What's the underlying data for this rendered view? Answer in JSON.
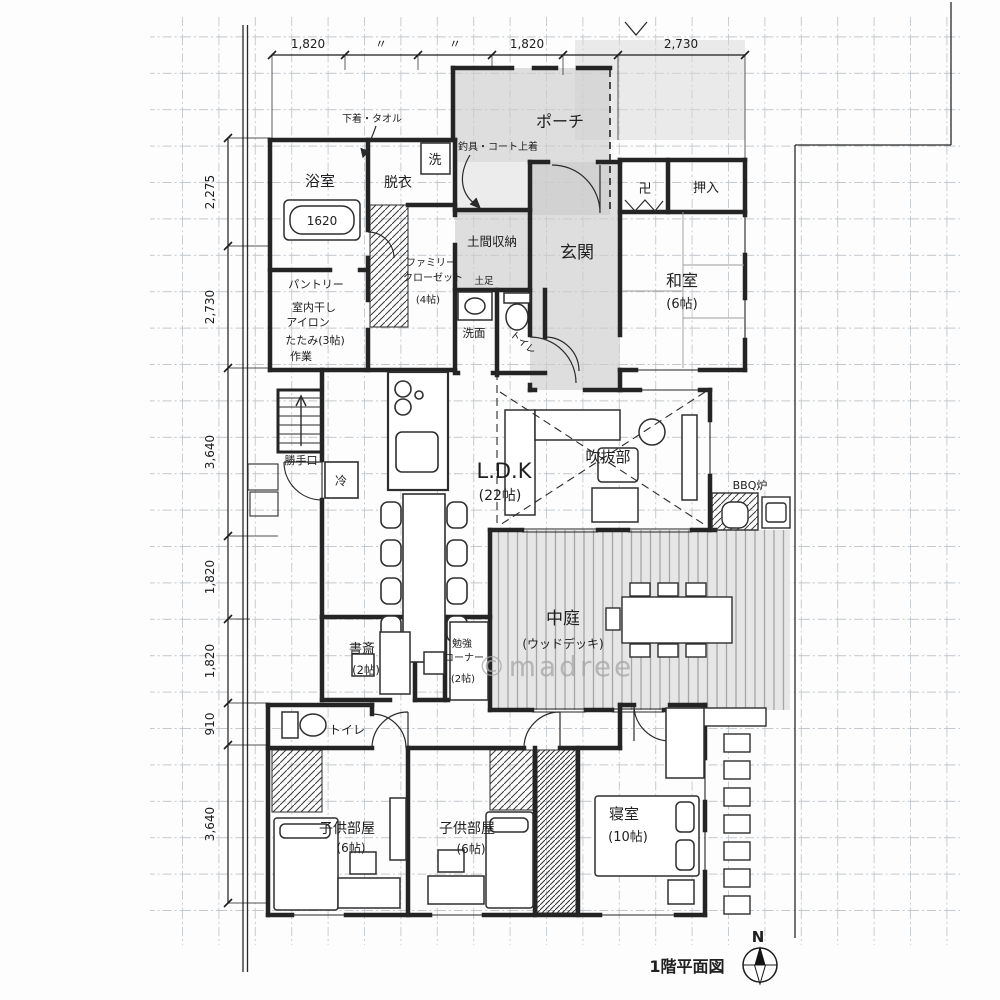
{
  "plan": {
    "title": "1階平面図",
    "watermark": "©madree",
    "compass_north": "N"
  },
  "dimensions": {
    "top": [
      "1,820",
      "〃",
      "〃",
      "1,820",
      "2,730"
    ],
    "left": [
      "2,275",
      "2,730",
      "3,640",
      "1,820",
      "1,820",
      "910",
      "3,640"
    ]
  },
  "rooms": {
    "bath": {
      "name": "浴室",
      "tub_size": "1620"
    },
    "dressing": {
      "name": "脱衣",
      "washer": "洗",
      "note": "下着・タオル"
    },
    "porch": {
      "name": "ポーチ",
      "note": "釣具・コート上着"
    },
    "entrance": {
      "name": "玄関"
    },
    "doma_storage": {
      "name": "土間収納",
      "sub": "土足"
    },
    "washroom": {
      "name": "洗面"
    },
    "toilet1": {
      "name": "トイレ"
    },
    "japanese_room": {
      "name": "和室",
      "size": "(6帖)",
      "altar": "卍",
      "closet": "押入"
    },
    "pantry": {
      "lines": [
        "パントリー",
        "室内干し",
        "アイロン",
        "たたみ(3帖)",
        "作業"
      ]
    },
    "family_closet": {
      "lines": [
        "ファミリー",
        "クローゼット",
        "(4帖)"
      ]
    },
    "back_door": {
      "name": "勝手口"
    },
    "fridge": {
      "name": "冷"
    },
    "ldk": {
      "name": "L.D.K",
      "size": "(22帖)"
    },
    "void": {
      "name": "吹抜部"
    },
    "bbq": {
      "name": "BBQ炉"
    },
    "courtyard": {
      "name": "中庭",
      "sub": "(ウッドデッキ)"
    },
    "study": {
      "name": "書斎",
      "size": "(2帖)"
    },
    "study_corner": {
      "lines": [
        "勉強",
        "コーナー",
        "(2帖)"
      ]
    },
    "toilet2": {
      "name": "トイレ"
    },
    "kids_room1": {
      "name": "子供部屋",
      "size": "(6帖)"
    },
    "kids_room2": {
      "name": "子供部屋",
      "size": "(6帖)"
    },
    "bedroom": {
      "name": "寝室",
      "size": "(10帖)"
    }
  },
  "colors": {
    "ink": "#242424",
    "shade": "#cbcbcb",
    "deck_bg": "#e6e6e6",
    "deck_stripe": "#a5a5a5",
    "grid": "#c2c8cd",
    "watermark": "#a6a6a6"
  }
}
